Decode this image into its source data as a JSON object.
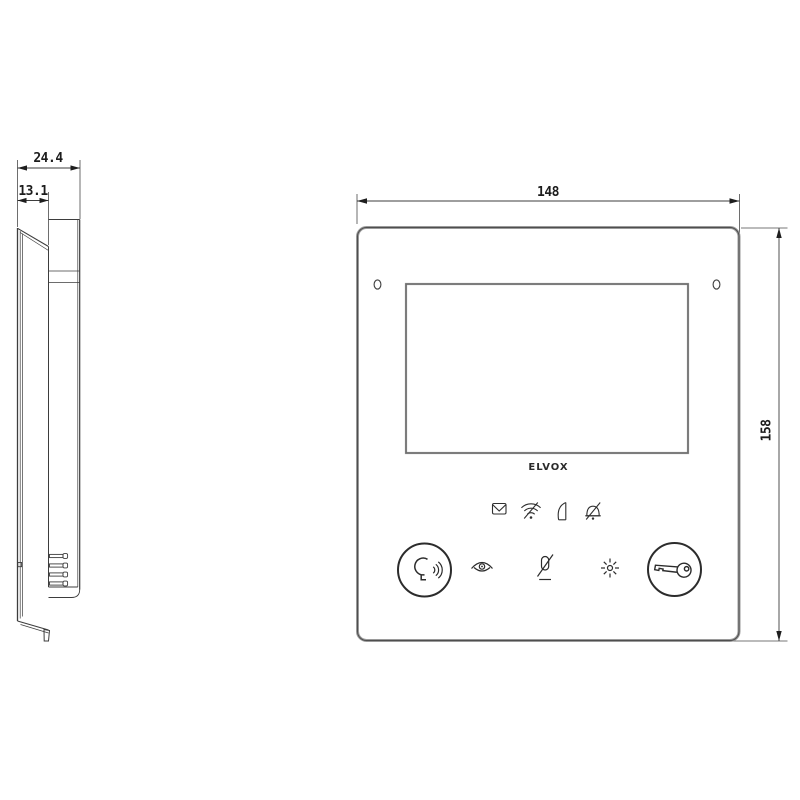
{
  "drawing": {
    "side_view": {
      "dim_total_depth": "24.4",
      "dim_front_depth": "13.1",
      "features": [
        "tilted-front-panel",
        "wall-bracket",
        "terminal-pins",
        "bottom-hook"
      ]
    },
    "front_view": {
      "dim_width": "148",
      "dim_height": "158",
      "logo": "ELVOX",
      "status_icons": [
        {
          "name": "message-icon"
        },
        {
          "name": "wifi-icon"
        },
        {
          "name": "open-door-icon"
        },
        {
          "name": "bell-muted-icon"
        }
      ],
      "controls": [
        {
          "name": "talk-answer-button",
          "icon": "talk-icon"
        },
        {
          "name": "camera-eye-icon"
        },
        {
          "name": "mic-muted-icon"
        },
        {
          "name": "stair-light-icon"
        },
        {
          "name": "door-lock-key-button",
          "icon": "key-icon"
        }
      ]
    },
    "colors": {
      "line": "#3d3d3d",
      "outline_gray": "#8a8a8a",
      "outline_core": "#555555",
      "background": "#ffffff"
    }
  }
}
